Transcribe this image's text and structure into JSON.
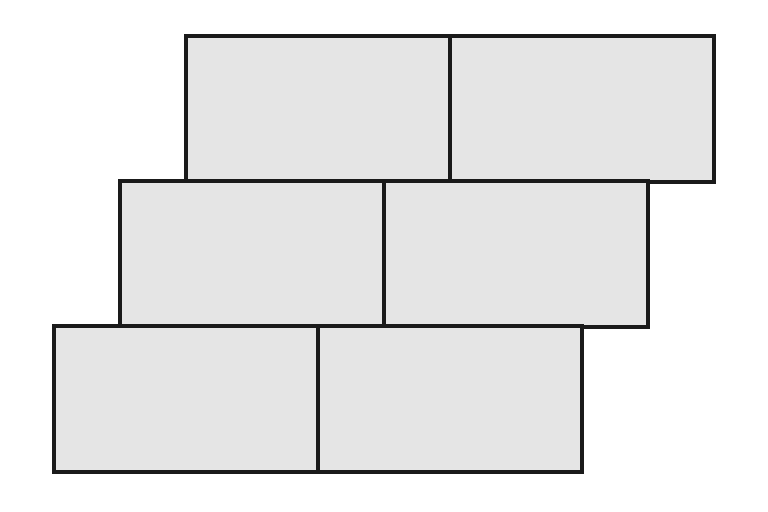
{
  "diagram": {
    "name": "staircase-brick-pattern",
    "canvas": {
      "width": 768,
      "height": 512,
      "background": "#ffffff"
    },
    "style": {
      "fill": "#e5e5e5",
      "stroke": "#1a1a1a",
      "stroke_width": 4
    },
    "rows": 3,
    "bricks_per_row": 2,
    "brick_size": {
      "width": 264,
      "height": 146
    },
    "bricks": [
      {
        "id": "row1-left",
        "row": 1,
        "col": 1,
        "x": 186,
        "y": 36,
        "w": 264,
        "h": 146
      },
      {
        "id": "row1-right",
        "row": 1,
        "col": 2,
        "x": 450,
        "y": 36,
        "w": 264,
        "h": 146
      },
      {
        "id": "row2-left",
        "row": 2,
        "col": 1,
        "x": 120,
        "y": 181,
        "w": 264,
        "h": 146
      },
      {
        "id": "row2-right",
        "row": 2,
        "col": 2,
        "x": 384,
        "y": 181,
        "w": 264,
        "h": 146
      },
      {
        "id": "row3-left",
        "row": 3,
        "col": 1,
        "x": 54,
        "y": 326,
        "w": 264,
        "h": 146
      },
      {
        "id": "row3-right",
        "row": 3,
        "col": 2,
        "x": 318,
        "y": 326,
        "w": 264,
        "h": 146
      }
    ]
  }
}
